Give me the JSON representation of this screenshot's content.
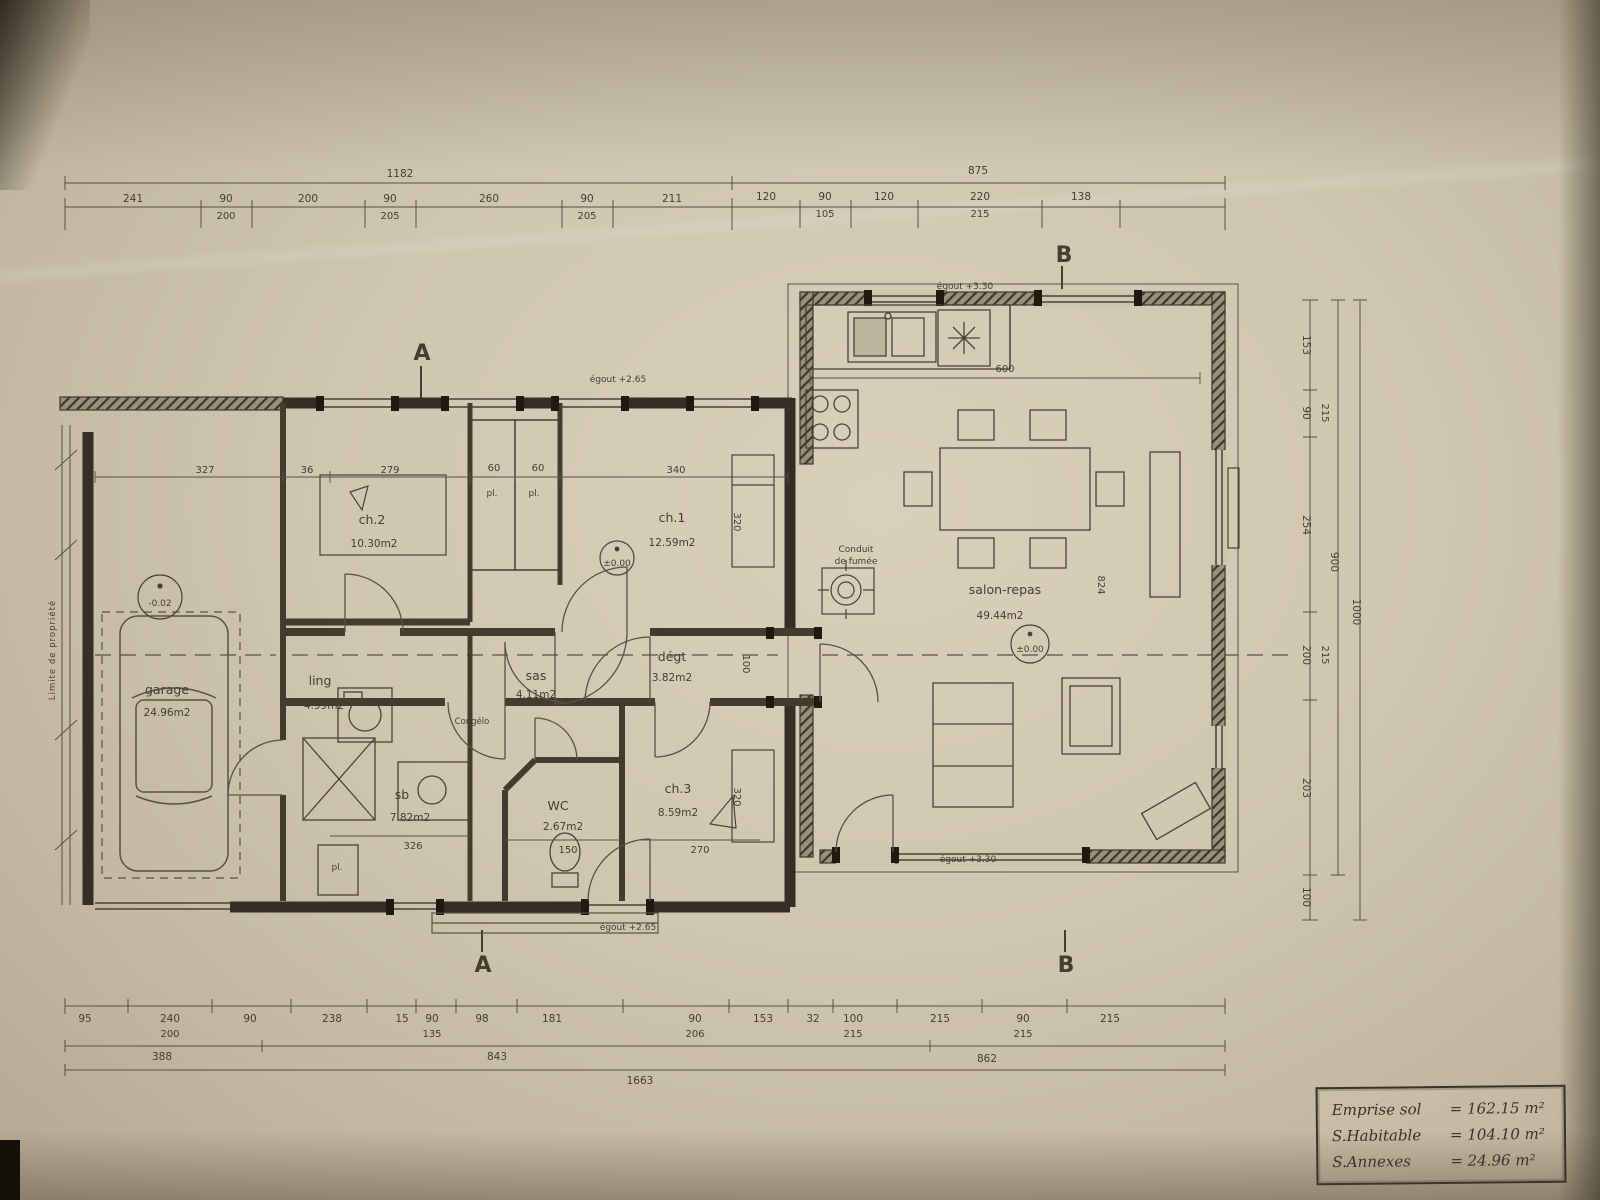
{
  "colors": {
    "paper": "#cfc6b0",
    "ink": "#463d2e",
    "wall": "#352e24"
  },
  "sections": {
    "a": "A",
    "b": "B"
  },
  "rooms": {
    "garage": {
      "name": "garage",
      "area": "24.96m2"
    },
    "ch1": {
      "name": "ch.1",
      "area": "12.59m2"
    },
    "ch2": {
      "name": "ch.2",
      "area": "10.30m2"
    },
    "ch3": {
      "name": "ch.3",
      "area": "8.59m2"
    },
    "ling": {
      "name": "ling",
      "area": "4.99m2"
    },
    "sb": {
      "name": "sb",
      "area": "7.82m2"
    },
    "wc": {
      "name": "WC",
      "area": "2.67m2"
    },
    "sas": {
      "name": "sas",
      "area": "4.11m2"
    },
    "degt": {
      "name": "dégt",
      "area": "3.82m2"
    },
    "salon": {
      "name": "salon-repas",
      "area": "49.44m2"
    }
  },
  "levels": {
    "garage": "-0.02",
    "entry": "±0.00",
    "salon": "±0.00"
  },
  "annotations": {
    "egout_left_top": "égout +2.65",
    "egout_left_bottom": "égout +2.65",
    "egout_right_top": "égout +3.30",
    "egout_right_bottom": "égout +3.30",
    "conduit_line1": "Conduit",
    "conduit_line2": "de fumée",
    "congelo": "Congélo",
    "placard1": "pl.",
    "placard2": "pl.",
    "placard3": "pl.",
    "limite": "Limite de propriété"
  },
  "dims": {
    "top": {
      "total_left": "1182",
      "total_right": "875",
      "row1": [
        "241",
        "90",
        "200",
        "90",
        "260",
        "90",
        "211",
        "120",
        "90",
        "120",
        "220",
        "138"
      ],
      "row2": [
        "200",
        "205",
        "205",
        "105",
        "215"
      ]
    },
    "bottom": {
      "row1": [
        "95",
        "240",
        "90",
        "238",
        "15",
        "90",
        "98",
        "181",
        "90",
        "153",
        "32",
        "100",
        "215",
        "90",
        "215"
      ],
      "row2": [
        "200",
        "135",
        "206",
        "215",
        "215"
      ],
      "row3": [
        "388",
        "843",
        "862"
      ],
      "total": "1663"
    },
    "right": {
      "row1": [
        "153",
        "90",
        "254",
        "200",
        "203",
        "100"
      ],
      "row2": [
        "215",
        "215"
      ],
      "subtotal": "900",
      "total": "1000"
    },
    "interior": {
      "garage_top": "327",
      "wall": "36",
      "ch2_top": "279",
      "pl_left": "60",
      "pl_right": "60",
      "ch1_top": "340",
      "ch1_right": "320",
      "ch3_right": "320",
      "kitchen_top": "600",
      "salon_right": "824",
      "ch3_bottom": "270",
      "wc_bottom": "150",
      "sb_bottom": "326",
      "corridor": "100"
    }
  },
  "legend": {
    "rows": [
      {
        "label": "Emprise sol",
        "value": "= 162.15 m²"
      },
      {
        "label": "S.Habitable",
        "value": "= 104.10 m²"
      },
      {
        "label": "S.Annexes",
        "value": "= 24.96 m²"
      }
    ]
  }
}
